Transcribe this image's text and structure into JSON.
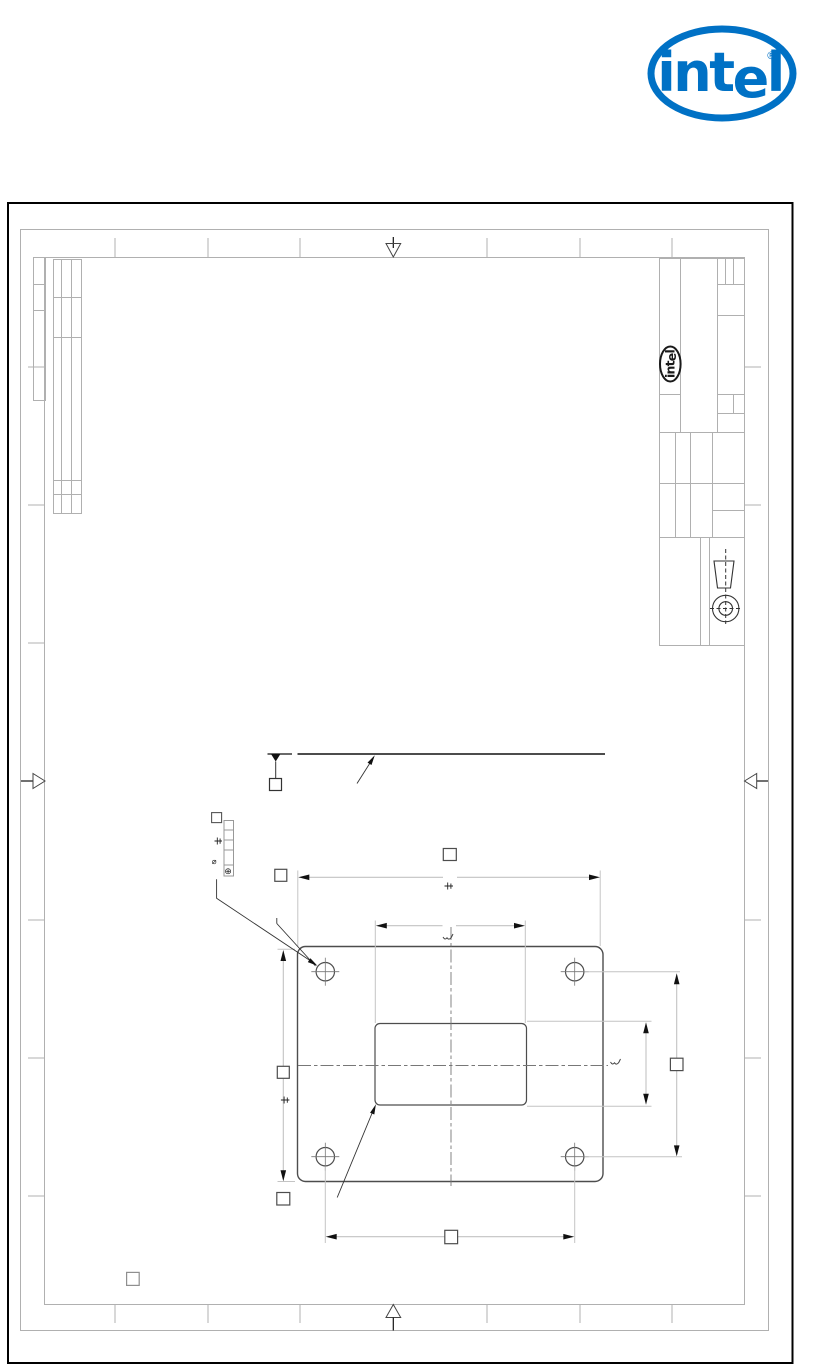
{
  "brand": {
    "logo_int": "int",
    "logo_e": "e",
    "logo_l": "l",
    "registered": "®",
    "color": "#0071c5"
  },
  "titleblock": {
    "logo_int": "int",
    "logo_e": "e",
    "logo_l": "l",
    "color": "#1a1a1a"
  },
  "symbols": {
    "diameter": "⌀",
    "position": "⊕"
  },
  "colors": {
    "sheet_border": "#000000",
    "frame": "#b0b0b0",
    "object_line": "#4d4d4d",
    "dimension_line": "#c2c2c2",
    "centerline": "#777777",
    "arrow": "#111111"
  },
  "icons": {
    "fold_mark_top": "triangle-down",
    "fold_mark_bottom": "triangle-up",
    "fold_mark_left": "triangle-right",
    "fold_mark_right": "triangle-left",
    "datum_flag": "filled-triangle-with-box",
    "projection_symbol": "third-angle-projection",
    "hole": "circle-with-centerlines"
  }
}
